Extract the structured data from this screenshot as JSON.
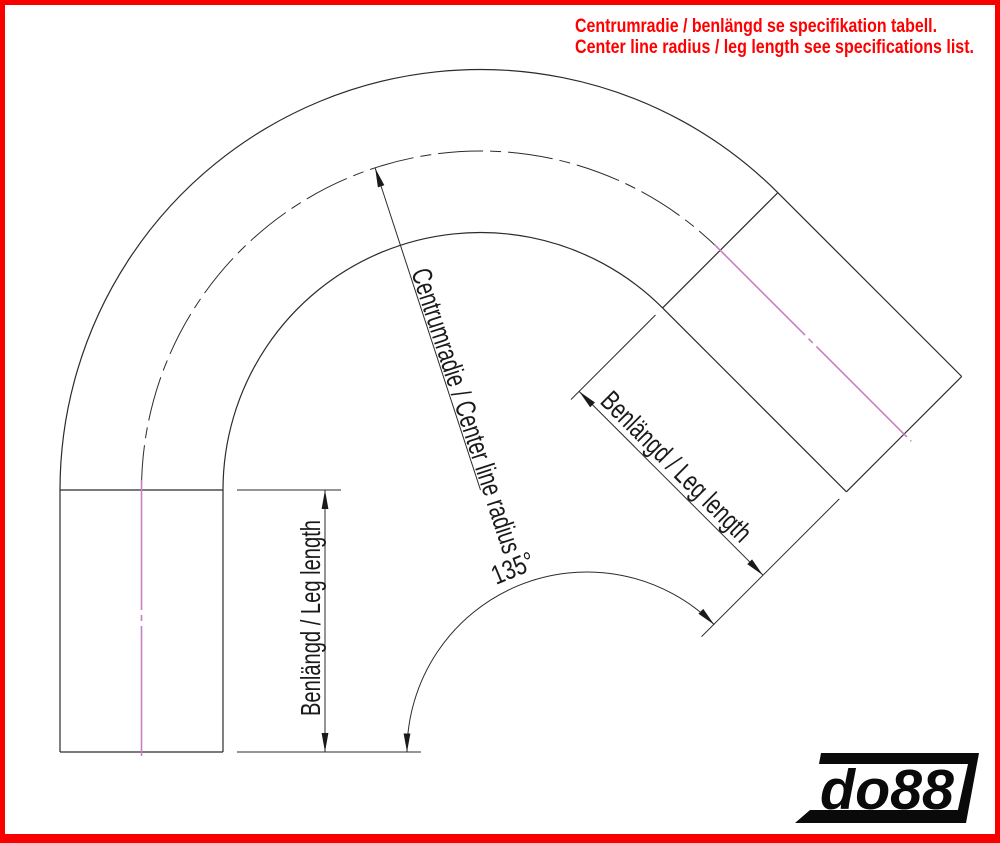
{
  "notes": {
    "line1": "Centrumradie / benlängd se specifikation tabell.",
    "line2": "Center line radius / leg length see specifications list."
  },
  "labels": {
    "center_radius": "Centrumradie / Center line radius",
    "left_leg": "Benlängd / Leg length",
    "right_leg": "Benlängd / Leg length",
    "angle": "135°"
  },
  "logo": {
    "text": "do88"
  },
  "colors": {
    "note_red": "#ff0000",
    "frame_red": "#f80000",
    "centerline_magenta": "#c77fc7",
    "drawing_black": "#2b2b2b"
  },
  "drawing": {
    "bend_angle_deg": 135
  }
}
